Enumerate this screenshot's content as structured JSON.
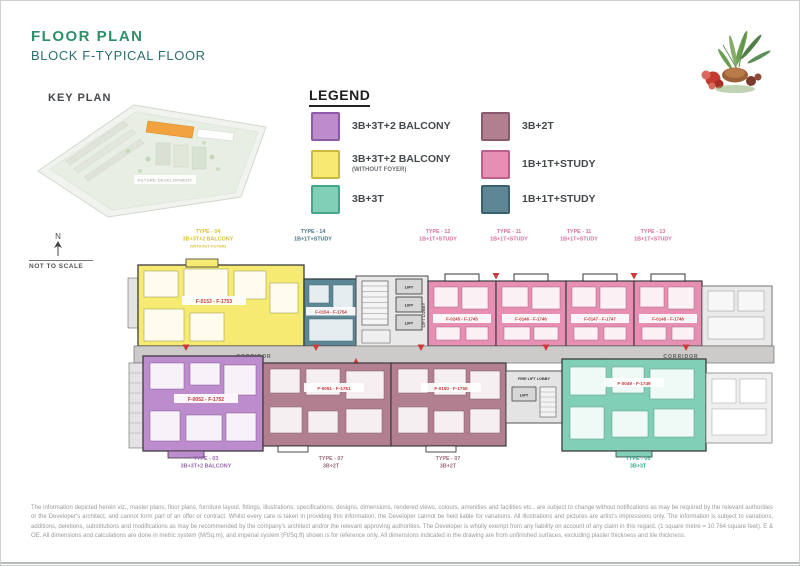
{
  "header": {
    "title": "FLOOR PLAN",
    "subtitle": "BLOCK F-TYPICAL FLOOR"
  },
  "key_plan": {
    "label": "KEY PLAN",
    "future_development": "FUTURE DEVELOPMENT",
    "north": "N",
    "not_to_scale": "NOT TO SCALE",
    "highlight_color": "#f2a23e"
  },
  "legend": {
    "title": "LEGEND",
    "items": [
      {
        "label": "3B+3T+2 BALCONY",
        "sublabel": "",
        "color": "#bd8ccd",
        "border": "#8f5aa8"
      },
      {
        "label": "3B+3T+2 BALCONY",
        "sublabel": "(WITHOUT FOYER)",
        "color": "#f6ea72",
        "border": "#cbb83e"
      },
      {
        "label": "3B+3T",
        "sublabel": "",
        "color": "#82cfb8",
        "border": "#45a58a"
      },
      {
        "label": "3B+2T",
        "sublabel": "",
        "color": "#b17f90",
        "border": "#8a5a6e"
      },
      {
        "label": "1B+1T+STUDY",
        "sublabel": "",
        "color": "#e68fb3",
        "border": "#bd5f8d"
      },
      {
        "label": "1B+1T+STUDY",
        "sublabel": "",
        "color": "#5d8795",
        "border": "#3a616f"
      }
    ]
  },
  "plan": {
    "top_labels": [
      {
        "line1": "TYPE - 04",
        "line2": "3B+3T+2 BALCONY",
        "line3": "(WITHOUT FOYER)"
      },
      {
        "line1": "TYPE - 14",
        "line2": "1B+1T+STUDY"
      },
      {
        "line1": "TYPE - 12",
        "line2": "1B+1T+STUDY"
      },
      {
        "line1": "TYPE - 11",
        "line2": "1B+1T+STUDY"
      },
      {
        "line1": "TYPE - 11",
        "line2": "1B+1T+STUDY"
      },
      {
        "line1": "TYPE - 13",
        "line2": "1B+1T+STUDY"
      }
    ],
    "bottom_labels": [
      {
        "line1": "TYPE - 03",
        "line2": "3B+3T+2 BALCONY"
      },
      {
        "line1": "TYPE - 07",
        "line2": "3B+2T"
      },
      {
        "line1": "TYPE - 07",
        "line2": "3B+2T"
      },
      {
        "line1": "TYPE - 05",
        "line2": "3B+3T"
      }
    ],
    "units": [
      {
        "number": "F-0153 - F-1753"
      },
      {
        "number": "F-0154 - F-1754"
      },
      {
        "number": "F-0245 - F-1745"
      },
      {
        "number": "F-0146 - F-1746"
      },
      {
        "number": "F-0147 - F-1747"
      },
      {
        "number": "F-0148 - F-1748"
      },
      {
        "number": "F-0052 - F-1752"
      },
      {
        "number": "F-0051 - F-1751"
      },
      {
        "number": "F-0150 - F-1750"
      },
      {
        "number": "F-0049 - F-1749"
      }
    ],
    "core": {
      "lift": "LIFT",
      "lift_lobby": "LIFT LOBBY",
      "corridor": "CORRIDOR",
      "fire_lift_lobby": "FIRE LIFT LOBBY"
    },
    "unit_number_color": "#c23a3a"
  },
  "disclaimer": "The information depicted herein viz., master plans, floor plans, furniture layout, fittings, illustrations, specifications, designs, dimensions, rendered views, colours, amenities and facilities etc., are subject to change without notifications as may be required by the relevant authorities or the Developer's architect, and cannot form part of an offer or contract. Whilst every care is taken in providing this information, the Developer cannot be held liable for variations. All illustrations and pictures are artist's impressions only. The information is subject to variations, additions, deletions, substitutions and modifications as may be recommended by the company's architect and/or the relevant approving authorities. The Developer is wholly exempt from any liability on account of any claim in this regard. (1 square metre = 10.764 square feet). E & OE. All dimensions and calculations are done in metric system (M/Sq.m), and imperial system (Ft/Sq.ft) shown is for reference only. All dimensions indicated in the drawing are from unfinished surfaces, excluding plaster thickness and tile thickness."
}
